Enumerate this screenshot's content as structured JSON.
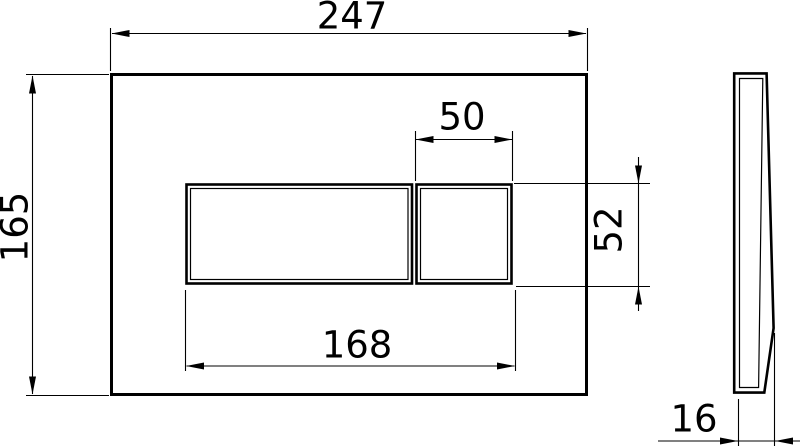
{
  "drawing": {
    "description": "Dimensioned technical drawing of a rectangular flush plate with one large and one small button, front view and side profile view",
    "background_color": "#ffffff",
    "line_color": "#000000",
    "dimensions": [
      {
        "id": "panel-width",
        "label": "247",
        "orientation": "horizontal",
        "applies_to": "front panel overall width"
      },
      {
        "id": "panel-height",
        "label": "165",
        "orientation": "vertical-rotated",
        "applies_to": "front panel overall height"
      },
      {
        "id": "small-button-width",
        "label": "50",
        "orientation": "horizontal",
        "applies_to": "small button width"
      },
      {
        "id": "button-height",
        "label": "52",
        "orientation": "vertical-rotated",
        "applies_to": "button row height"
      },
      {
        "id": "button-group-width",
        "label": "168",
        "orientation": "horizontal",
        "applies_to": "combined button group width"
      },
      {
        "id": "plate-thickness",
        "label": "16",
        "orientation": "horizontal",
        "applies_to": "side profile thickness"
      }
    ]
  }
}
